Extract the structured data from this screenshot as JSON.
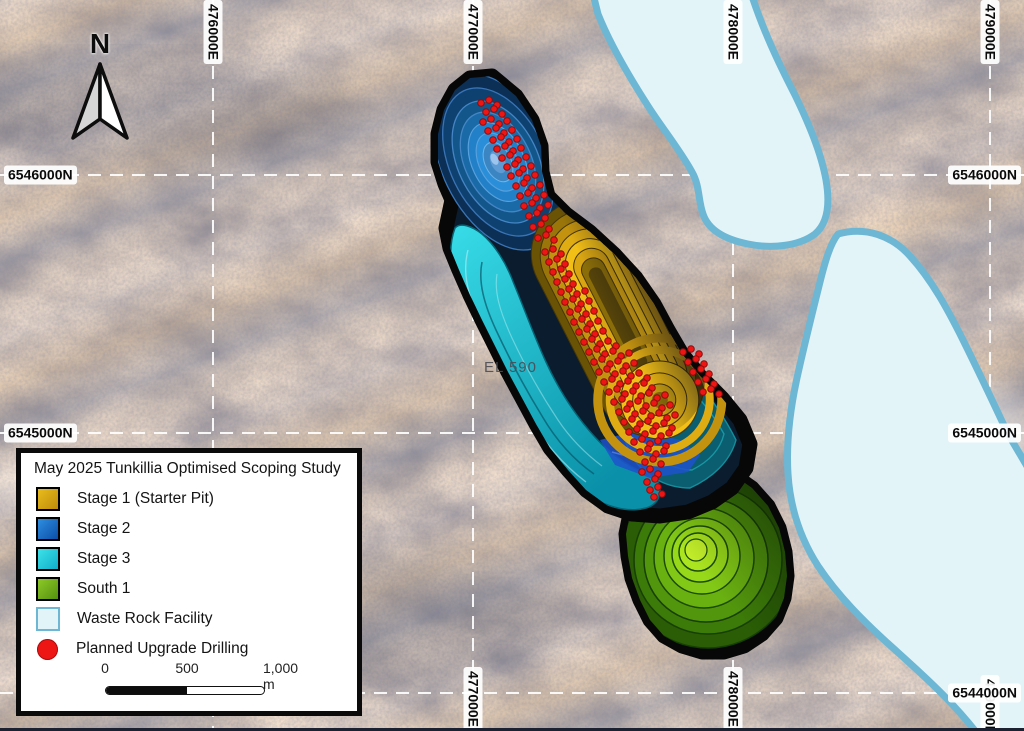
{
  "map": {
    "north_label": "N",
    "area_label": "EL 590",
    "grid": {
      "eastings": [
        {
          "label": "476000E",
          "x": 213,
          "top": true,
          "bottom": false
        },
        {
          "label": "477000E",
          "x": 473,
          "top": true,
          "bottom": true
        },
        {
          "label": "478000E",
          "x": 733,
          "top": true,
          "bottom": true
        },
        {
          "label": "479000E",
          "x": 990,
          "top": true,
          "bottom": true,
          "bottom_y": 707
        }
      ],
      "northings": [
        {
          "label": "6546000N",
          "y": 175,
          "left": true,
          "right": true
        },
        {
          "label": "6545000N",
          "y": 433,
          "left": true,
          "right": true
        },
        {
          "label": "6544000N",
          "y": 693,
          "left": false,
          "right": true
        }
      ]
    },
    "drill_points": [
      [
        481,
        103
      ],
      [
        489,
        100
      ],
      [
        497,
        105
      ],
      [
        486,
        112
      ],
      [
        494,
        109
      ],
      [
        502,
        114
      ],
      [
        483,
        122
      ],
      [
        491,
        119
      ],
      [
        499,
        124
      ],
      [
        507,
        121
      ],
      [
        488,
        131
      ],
      [
        496,
        128
      ],
      [
        504,
        133
      ],
      [
        512,
        130
      ],
      [
        493,
        140
      ],
      [
        501,
        137
      ],
      [
        509,
        142
      ],
      [
        517,
        139
      ],
      [
        497,
        149
      ],
      [
        505,
        146
      ],
      [
        513,
        151
      ],
      [
        521,
        148
      ],
      [
        502,
        158
      ],
      [
        510,
        155
      ],
      [
        518,
        160
      ],
      [
        526,
        157
      ],
      [
        507,
        167
      ],
      [
        515,
        164
      ],
      [
        523,
        169
      ],
      [
        531,
        166
      ],
      [
        511,
        176
      ],
      [
        519,
        173
      ],
      [
        527,
        178
      ],
      [
        535,
        175
      ],
      [
        516,
        186
      ],
      [
        524,
        183
      ],
      [
        532,
        188
      ],
      [
        540,
        185
      ],
      [
        520,
        196
      ],
      [
        528,
        193
      ],
      [
        536,
        198
      ],
      [
        544,
        195
      ],
      [
        524,
        206
      ],
      [
        532,
        203
      ],
      [
        540,
        208
      ],
      [
        548,
        205
      ],
      [
        529,
        216
      ],
      [
        537,
        213
      ],
      [
        545,
        218
      ],
      [
        533,
        227
      ],
      [
        541,
        224
      ],
      [
        549,
        229
      ],
      [
        538,
        238
      ],
      [
        546,
        235
      ],
      [
        554,
        240
      ],
      [
        545,
        252
      ],
      [
        553,
        249
      ],
      [
        561,
        254
      ],
      [
        549,
        262
      ],
      [
        557,
        259
      ],
      [
        565,
        264
      ],
      [
        553,
        272
      ],
      [
        561,
        269
      ],
      [
        569,
        274
      ],
      [
        557,
        282
      ],
      [
        565,
        279
      ],
      [
        573,
        284
      ],
      [
        561,
        292
      ],
      [
        569,
        289
      ],
      [
        577,
        294
      ],
      [
        585,
        291
      ],
      [
        565,
        302
      ],
      [
        573,
        299
      ],
      [
        581,
        304
      ],
      [
        589,
        301
      ],
      [
        570,
        312
      ],
      [
        578,
        309
      ],
      [
        586,
        314
      ],
      [
        594,
        311
      ],
      [
        574,
        322
      ],
      [
        582,
        319
      ],
      [
        590,
        324
      ],
      [
        598,
        321
      ],
      [
        579,
        332
      ],
      [
        587,
        329
      ],
      [
        595,
        334
      ],
      [
        603,
        331
      ],
      [
        584,
        342
      ],
      [
        592,
        339
      ],
      [
        600,
        344
      ],
      [
        608,
        341
      ],
      [
        616,
        346
      ],
      [
        589,
        352
      ],
      [
        597,
        349
      ],
      [
        605,
        354
      ],
      [
        613,
        351
      ],
      [
        621,
        356
      ],
      [
        629,
        353
      ],
      [
        594,
        362
      ],
      [
        602,
        359
      ],
      [
        610,
        364
      ],
      [
        618,
        361
      ],
      [
        626,
        366
      ],
      [
        634,
        363
      ],
      [
        599,
        372
      ],
      [
        607,
        369
      ],
      [
        615,
        374
      ],
      [
        623,
        371
      ],
      [
        631,
        376
      ],
      [
        639,
        373
      ],
      [
        647,
        378
      ],
      [
        604,
        382
      ],
      [
        612,
        379
      ],
      [
        620,
        384
      ],
      [
        628,
        381
      ],
      [
        636,
        386
      ],
      [
        644,
        383
      ],
      [
        652,
        388
      ],
      [
        609,
        392
      ],
      [
        617,
        389
      ],
      [
        625,
        394
      ],
      [
        633,
        391
      ],
      [
        641,
        396
      ],
      [
        649,
        393
      ],
      [
        657,
        398
      ],
      [
        665,
        395
      ],
      [
        614,
        402
      ],
      [
        622,
        399
      ],
      [
        630,
        404
      ],
      [
        638,
        401
      ],
      [
        646,
        406
      ],
      [
        654,
        403
      ],
      [
        662,
        408
      ],
      [
        670,
        405
      ],
      [
        619,
        412
      ],
      [
        627,
        409
      ],
      [
        635,
        414
      ],
      [
        643,
        411
      ],
      [
        651,
        416
      ],
      [
        659,
        413
      ],
      [
        667,
        418
      ],
      [
        675,
        415
      ],
      [
        624,
        422
      ],
      [
        632,
        419
      ],
      [
        640,
        424
      ],
      [
        648,
        421
      ],
      [
        656,
        426
      ],
      [
        664,
        423
      ],
      [
        672,
        428
      ],
      [
        629,
        432
      ],
      [
        637,
        429
      ],
      [
        645,
        434
      ],
      [
        653,
        431
      ],
      [
        661,
        436
      ],
      [
        669,
        433
      ],
      [
        634,
        442
      ],
      [
        642,
        439
      ],
      [
        650,
        444
      ],
      [
        658,
        441
      ],
      [
        666,
        446
      ],
      [
        640,
        452
      ],
      [
        648,
        449
      ],
      [
        656,
        454
      ],
      [
        664,
        451
      ],
      [
        645,
        462
      ],
      [
        653,
        459
      ],
      [
        661,
        464
      ],
      [
        683,
        352
      ],
      [
        691,
        349
      ],
      [
        699,
        354
      ],
      [
        688,
        362
      ],
      [
        696,
        359
      ],
      [
        704,
        364
      ],
      [
        693,
        372
      ],
      [
        701,
        369
      ],
      [
        709,
        374
      ],
      [
        698,
        382
      ],
      [
        706,
        379
      ],
      [
        714,
        384
      ],
      [
        703,
        392
      ],
      [
        711,
        389
      ],
      [
        719,
        394
      ],
      [
        642,
        472
      ],
      [
        650,
        469
      ],
      [
        658,
        474
      ],
      [
        647,
        482
      ],
      [
        655,
        479
      ],
      [
        650,
        490
      ],
      [
        658,
        487
      ],
      [
        654,
        497
      ],
      [
        662,
        494
      ]
    ]
  },
  "legend": {
    "title": "May 2025 Tunkillia Optimised Scoping Study",
    "items": [
      {
        "label": "Stage 1 (Starter Pit)",
        "swatch": "stage1"
      },
      {
        "label": "Stage 2",
        "swatch": "stage2"
      },
      {
        "label": "Stage 3",
        "swatch": "stage3"
      },
      {
        "label": "South 1",
        "swatch": "south1"
      },
      {
        "label": "Waste Rock Facility",
        "swatch": "waste"
      },
      {
        "label": "Planned Upgrade Drilling",
        "swatch": "drill"
      }
    ],
    "scalebar": {
      "tick0": "0",
      "tick500": "500",
      "tick1000": "1,000 m"
    }
  },
  "colors": {
    "stage1_top": "#e9bc1c",
    "stage1_bottom": "#bf8b0c",
    "stage2_top": "#2e8fe0",
    "stage2_bottom": "#0c4da8",
    "stage3_top": "#3ce2e8",
    "stage3_bottom": "#12aeca",
    "south1_top": "#8ec927",
    "south1_bottom": "#539110",
    "waste_fill": "#e3f4f8",
    "waste_border": "#6db7d4",
    "drill_red": "#ee1515",
    "grid_line": "#ffffff"
  }
}
